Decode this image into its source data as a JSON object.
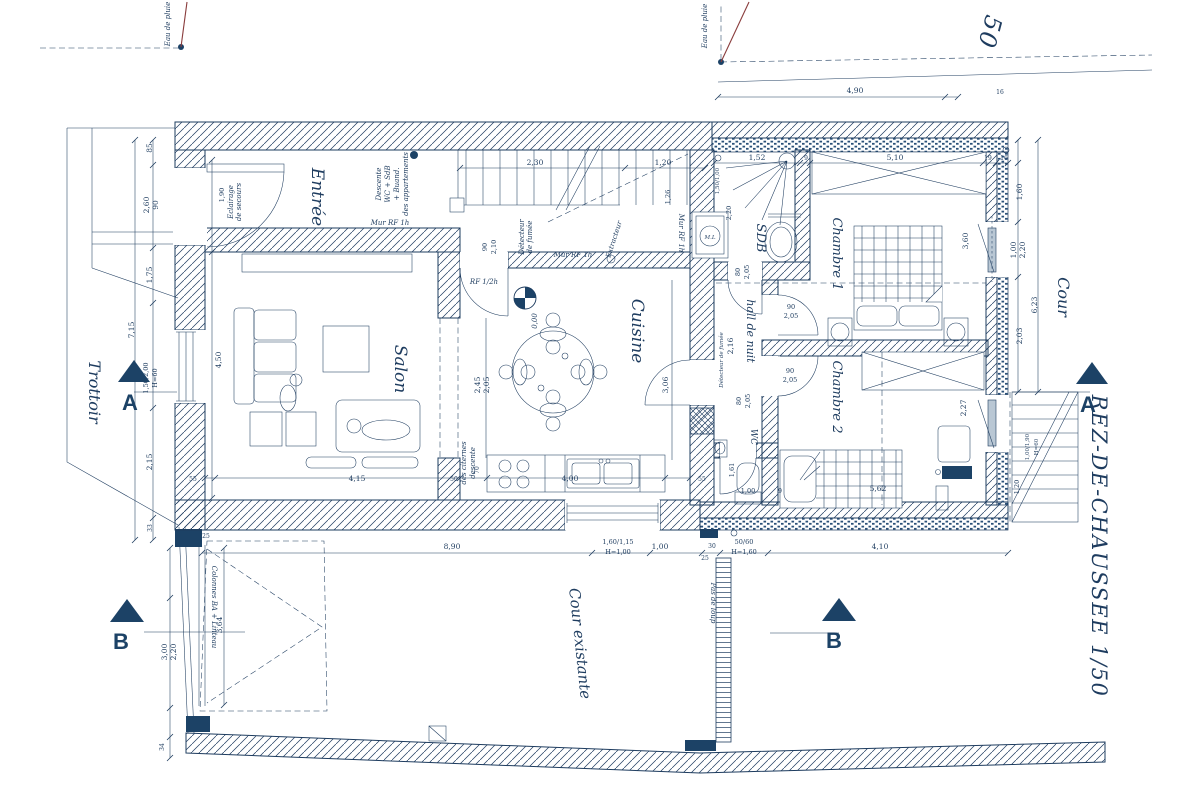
{
  "drawing": {
    "title": "REZ-DE-CHAUSSEE 1/50",
    "adjacent_title_fragment": "50"
  },
  "rooms": {
    "entree": "Entrée",
    "salon": "Salon",
    "cuisine": "Cuisine",
    "sdb": "SDB",
    "chambre1": "Chambre 1",
    "chambre2": "Chambre 2",
    "hall_de_nuit": "hall de nuit",
    "wc": "WC",
    "cour": "Cour",
    "cour_existante": "Cour existante",
    "trottoir": "Trottoir"
  },
  "markers": {
    "a": "A",
    "b": "B"
  },
  "annotations": {
    "eau_de_pluie": "Eau de pluie",
    "eclairage_1": "Eclairage",
    "eclairage_2": "de secours",
    "descente_1": "Descente",
    "descente_2": "WC + SdB",
    "descente_3": "+ Buand.",
    "descente_4": "des appartements",
    "mur_rf": "Mur RF 1h",
    "rf_demi": "RF 1/2h",
    "detecteur_1": "Détecteur",
    "detecteur_2": "de fumée",
    "detecteur_full": "Détecteur de fumée",
    "extracteur": "Extracteur",
    "niveau": "0,00",
    "ml": "M.L",
    "colonnes": "Colonnes BA + Linteau",
    "pas_de_loup": "Pas de loup",
    "citernes_1": "descente",
    "citernes_2": "des citernes"
  },
  "dims": {
    "v2_30": "2,30",
    "v1_20": "1,20",
    "v1_26": "1,26",
    "v1_52": "1,52",
    "v5_10": "5,10",
    "v19": "19",
    "v16": "16",
    "v9": "9",
    "v4_90": "4,90",
    "v8_90": "8,90",
    "v160_115": "1,60/1,15",
    "vH100": "H=1,00",
    "v1_00": "1,00",
    "v30": "30",
    "v25": "25",
    "v50_60": "50/60",
    "vH160": "H=1,60",
    "v4_10": "4,10",
    "v4_15": "4,15",
    "v55": "55",
    "v50": "50",
    "v4_00": "4,00",
    "v5_62": "5,62",
    "v90": "90",
    "v2_05": "2,05",
    "v1_90": "1,90",
    "v85": "85",
    "v2_60": "2,60",
    "v1_75": "1,75",
    "v7_15": "7,15",
    "v150_200": "1,50/2,00",
    "vH60": "H=60",
    "v2_15": "2,15",
    "v33": "33",
    "v3_00": "3,00",
    "v2_20": "2,20",
    "v3_64": "3,64",
    "v34": "34",
    "v4_50": "4,50",
    "v2_45": "2,45",
    "v3_06": "3,06",
    "v2_10": "2,10",
    "v2_16": "2,16",
    "v80": "80",
    "v1_61": "1,61",
    "v2_27": "2,27",
    "v3_60": "3,60",
    "v1_60": "1,60",
    "v2_03": "2,03",
    "v6_23": "6,23",
    "v100_190": "1,00/1,90",
    "v150_100": "1,50/1,00",
    "v70": "70"
  }
}
